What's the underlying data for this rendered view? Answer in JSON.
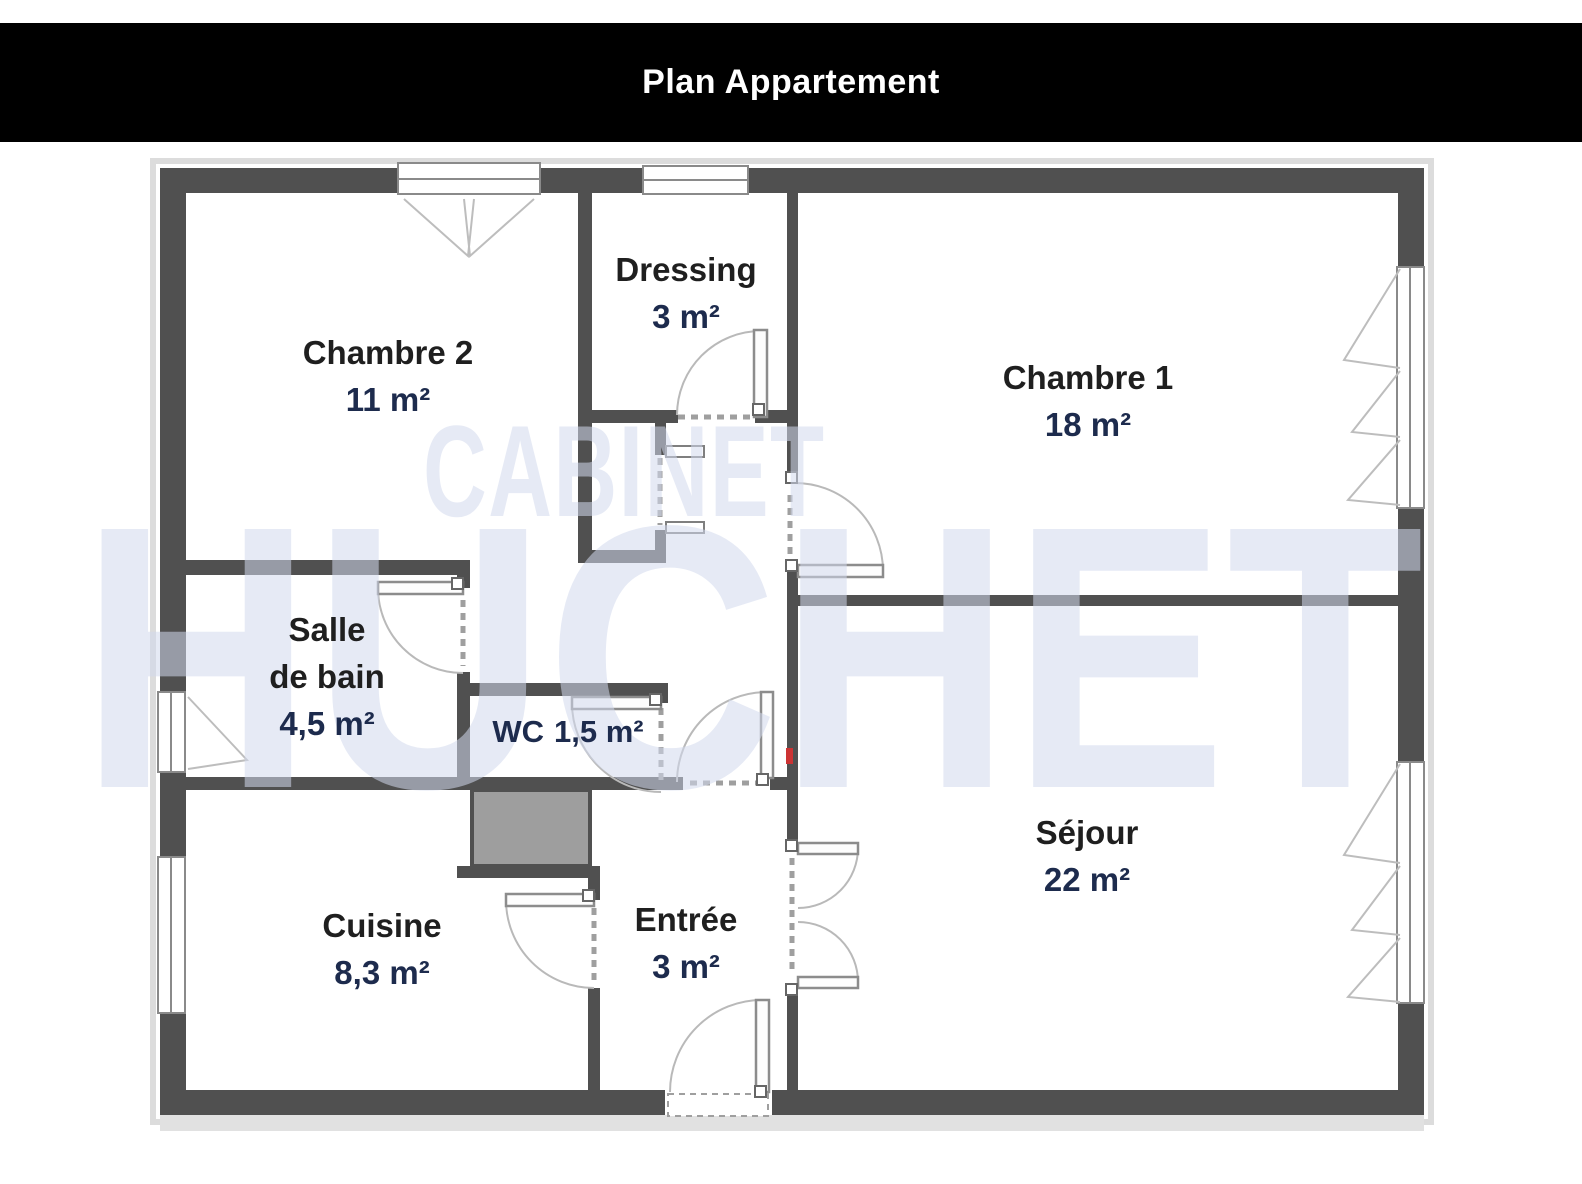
{
  "title_bar": {
    "title": "Plan Appartement"
  },
  "watermark": {
    "line1": "CABINET",
    "line2": "HUCHET"
  },
  "colors": {
    "title_bg": "#000000",
    "title_text": "#ffffff",
    "wall": "#505050",
    "room_name": "#1f1f1f",
    "room_area": "#1d2b4d",
    "door_arc": "#b9b9b9",
    "opening_dash": "#9f9f9f",
    "shaft_fill": "#9e9e9e",
    "outer_outline": "#dcdcdc",
    "watermark": "rgba(210,217,236,0.55)"
  },
  "rooms": [
    {
      "id": "chambre2",
      "name": "Chambre 2",
      "area": "11 m²"
    },
    {
      "id": "dressing",
      "name": "Dressing",
      "area": "3 m²"
    },
    {
      "id": "chambre1",
      "name": "Chambre 1",
      "area": "18 m²"
    },
    {
      "id": "salle_de_bain",
      "name": "Salle\nde bain",
      "area": "4,5 m²"
    },
    {
      "id": "wc",
      "name": "WC",
      "area": "1,5 m²"
    },
    {
      "id": "sejour",
      "name": "Séjour",
      "area": "22 m²"
    },
    {
      "id": "cuisine",
      "name": "Cuisine",
      "area": "8,3 m²"
    },
    {
      "id": "entree",
      "name": "Entrée",
      "area": "3 m²"
    }
  ]
}
